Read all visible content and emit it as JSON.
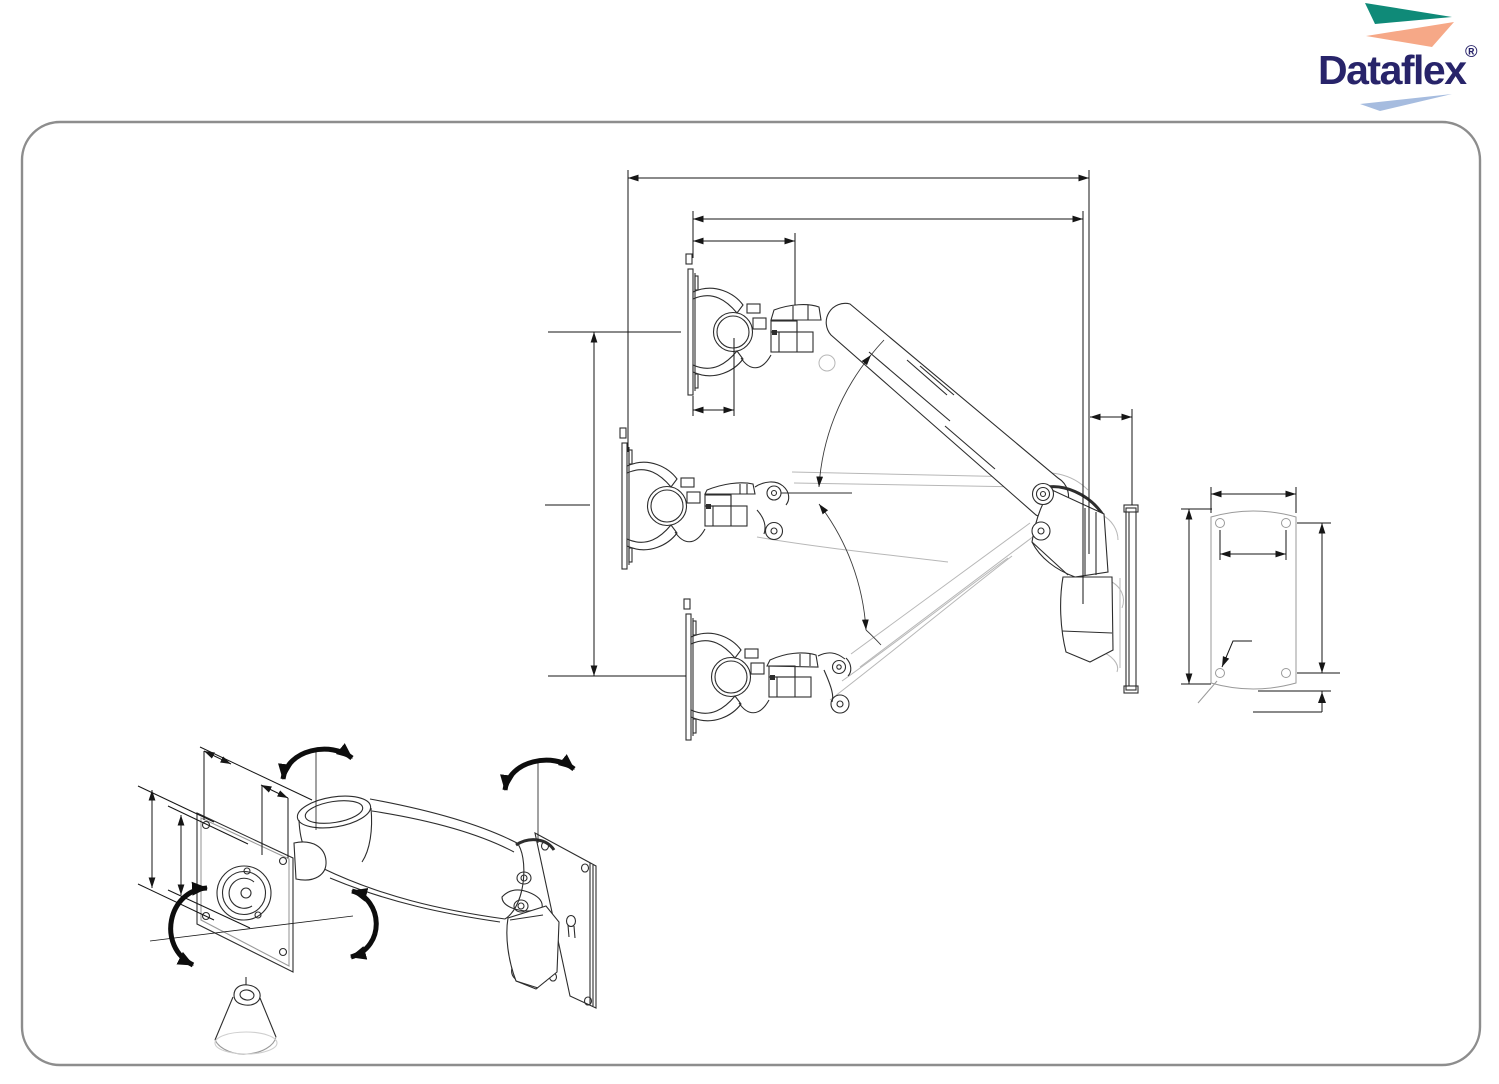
{
  "document": {
    "kind": "technical-drawing-sheet",
    "subject": "wall-mounted gas-spring monitor arm",
    "background": "#ffffff",
    "frame_border_color": "#8d8d8d"
  },
  "logo": {
    "wordmark": "Dataflex",
    "registered_mark": "®",
    "colors": {
      "teal": "#0f8a78",
      "salmon": "#f6a887",
      "light_blue": "#a6bcdf",
      "navy": "#28246a"
    }
  },
  "drawing": {
    "stroke_colors": {
      "solid": "#2d2d2d",
      "phantom": "#b7b7b7",
      "dimension": "#161616",
      "arrow": "#0d0d0d"
    },
    "views": {
      "side_view": {
        "name": "side-view-range-of-motion",
        "positions": [
          "raised",
          "horizontal",
          "lowered"
        ]
      },
      "wall_plate_front": {
        "name": "wall-plate-front-view",
        "hole_count": 4
      },
      "perspective": {
        "name": "perspective-view-rotation-axes",
        "rotation_arrow_count": 4
      }
    }
  }
}
